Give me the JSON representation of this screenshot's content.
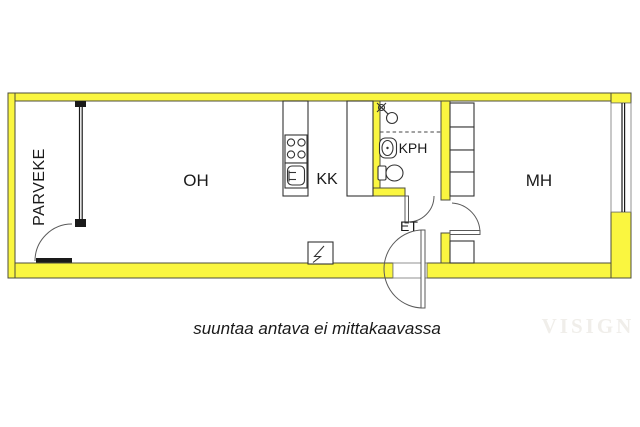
{
  "plan": {
    "title": "apartment-floor-plan",
    "rooms": {
      "parveke": {
        "label": "PARVEKE"
      },
      "oh": {
        "label": "OH"
      },
      "kk": {
        "label": "KK"
      },
      "kph": {
        "label": "KPH"
      },
      "et": {
        "label": "ET"
      },
      "mh": {
        "label": "MH"
      }
    },
    "fixtures": {
      "kph": [
        "shower-icon",
        "washbasin-icon",
        "toilet-icon"
      ],
      "kk": [
        "stove-icon",
        "kitchen-sink-icon",
        "tall-cabinet"
      ],
      "mh": [
        "wardrobe-units",
        "window"
      ],
      "oh": [
        "electrical-panel-icon"
      ],
      "doors": [
        "balcony-door",
        "bathroom-door",
        "bedroom-door",
        "entrance-door"
      ]
    },
    "caption": "suuntaa antava ei mittakaavassa",
    "watermark": "VISIGN",
    "colors": {
      "background": "#FFFFFF",
      "wall_fill": "#FAF640",
      "wall_stroke": "#4D4D3C",
      "fixture": "#333333",
      "text": "#1A1A1A",
      "watermark": "#F0EEEA"
    }
  }
}
